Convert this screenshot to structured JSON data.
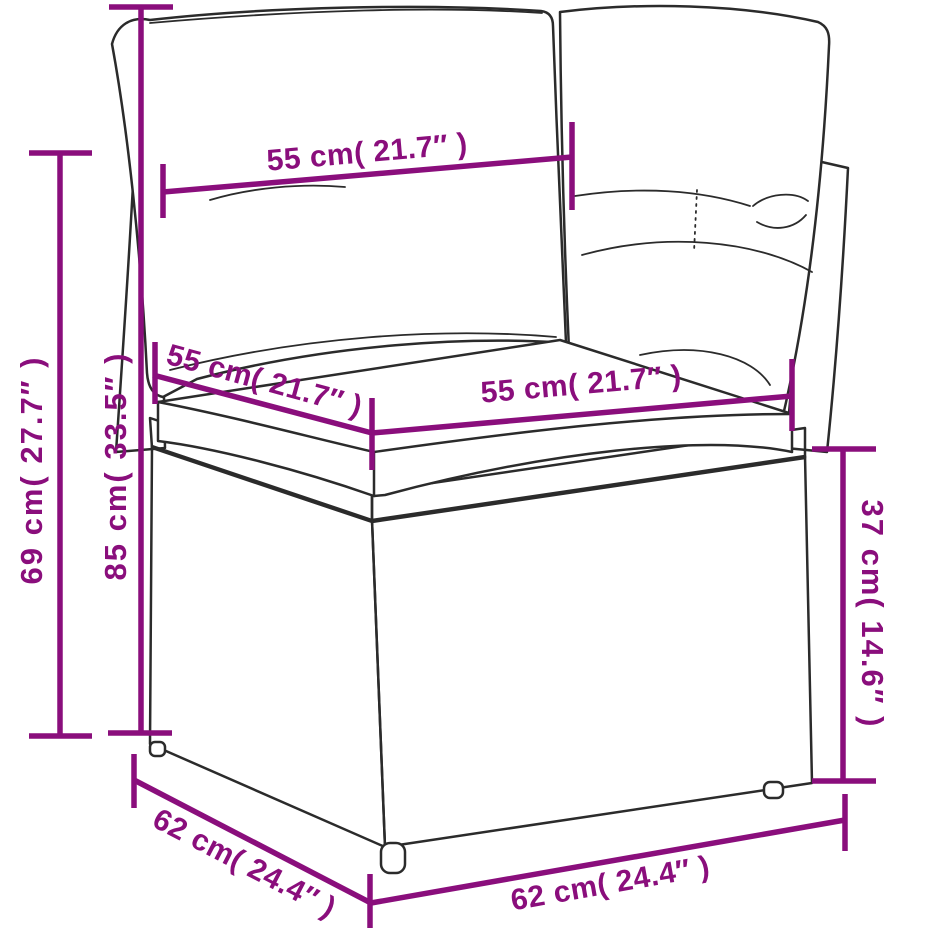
{
  "page": {
    "background_color": "#ffffff",
    "accent_color": "#8a0e7c",
    "line_art_color": "#2b2b2b"
  },
  "diagram": {
    "subject": "poly rattan corner sofa section with back and seat cushions, annotated dimension drawing",
    "dimensions": {
      "back_width": {
        "label": "55 cm( 21.7″ )",
        "cm": 55,
        "inch": 21.7
      },
      "seat_depth": {
        "label": "55 cm( 21.7″ )",
        "cm": 55,
        "inch": 21.7
      },
      "seat_front_width": {
        "label": "55 cm( 21.7″ )",
        "cm": 55,
        "inch": 21.7
      },
      "back_frame_height": {
        "label": "69 cm( 27.7″ )",
        "cm": 69,
        "inch": 27.7
      },
      "total_height": {
        "label": "85 cm( 33.5″ )",
        "cm": 85,
        "inch": 33.5
      },
      "base_height": {
        "label": "37 cm( 14.6″ )",
        "cm": 37,
        "inch": 14.6
      },
      "base_side_depth": {
        "label": "62 cm( 24.4″ )",
        "cm": 62,
        "inch": 24.4
      },
      "base_front_width": {
        "label": "62 cm( 24.4″ )",
        "cm": 62,
        "inch": 24.4
      }
    }
  }
}
